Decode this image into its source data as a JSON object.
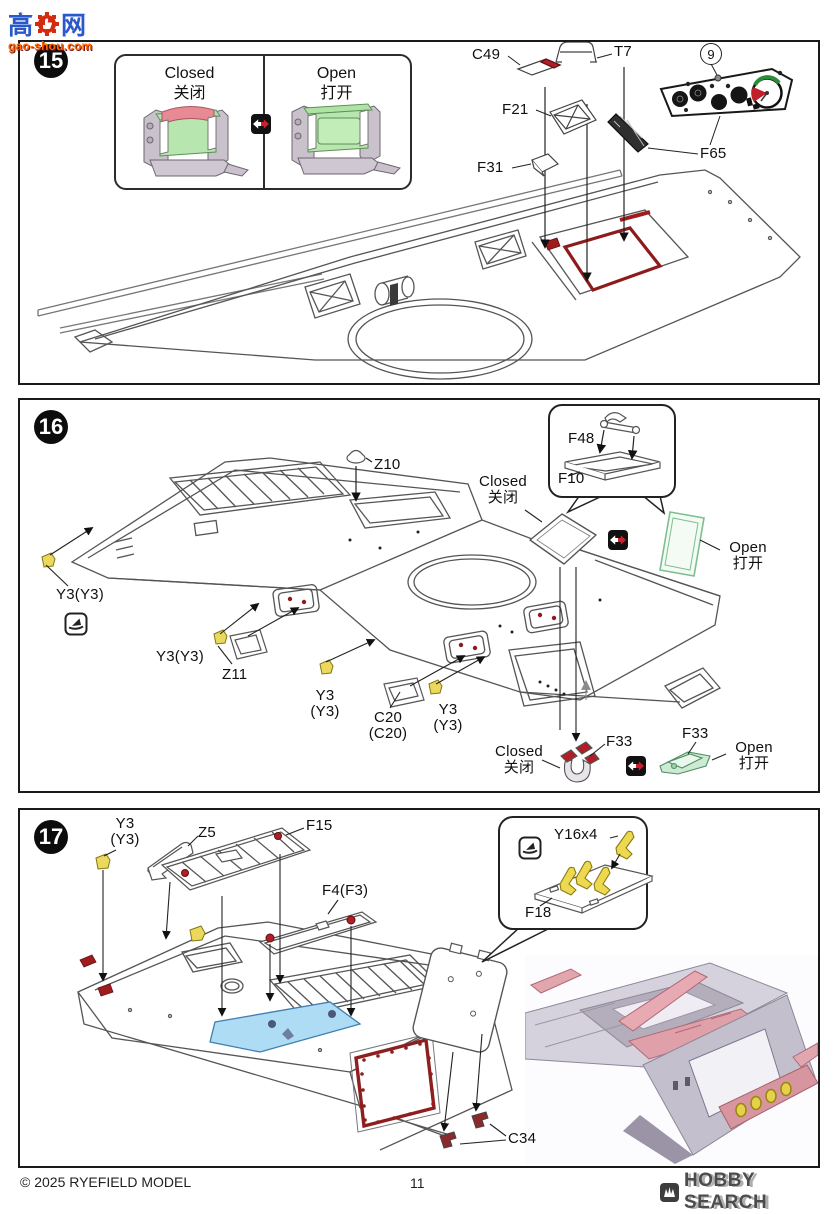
{
  "page": {
    "watermark_logo": {
      "char_left": "高",
      "char_right": "网",
      "url": "gao-shou.com"
    },
    "footer": {
      "copyright": "© 2025 RYEFIELD MODEL",
      "page_number": "11",
      "watermark": "HOBBY SEARCH"
    }
  },
  "steps": {
    "s15": {
      "number": "15",
      "inset": {
        "closed_en": "Closed",
        "closed_zh": "关闭",
        "open_en": "Open",
        "open_zh": "打开"
      },
      "labels": {
        "c49": "C49",
        "t7": "T7",
        "decal_no": "9",
        "f21": "F21",
        "f31": "F31",
        "f65": "F65"
      }
    },
    "s16": {
      "number": "16",
      "labels": {
        "z10": "Z10",
        "y3_left": "Y3(Y3)",
        "y3_mid": "Y3(Y3)",
        "z11": "Z11",
        "y3_c_l1": "Y3",
        "y3_c_l2": "(Y3)",
        "c20_l1": "C20",
        "c20_l2": "(C20)",
        "y3_r_l1": "Y3",
        "y3_r_l2": "(Y3)",
        "f48": "F48",
        "f10": "F10",
        "f33_closed": "F33",
        "f33_open": "F33"
      },
      "texts": {
        "hatch_closed_en": "Closed",
        "hatch_closed_zh": "关闭",
        "hatch_open_en": "Open",
        "hatch_open_zh": "打开",
        "f33_closed_en": "Closed",
        "f33_closed_zh": "关闭",
        "f33_open_en": "Open",
        "f33_open_zh": "打开"
      }
    },
    "s17": {
      "number": "17",
      "labels": {
        "y3_l1": "Y3",
        "y3_l2": "(Y3)",
        "z5": "Z5",
        "f15": "F15",
        "f4": "F4(F3)",
        "y16": "Y16x4",
        "f18": "F18",
        "c34": "C34"
      }
    }
  }
}
